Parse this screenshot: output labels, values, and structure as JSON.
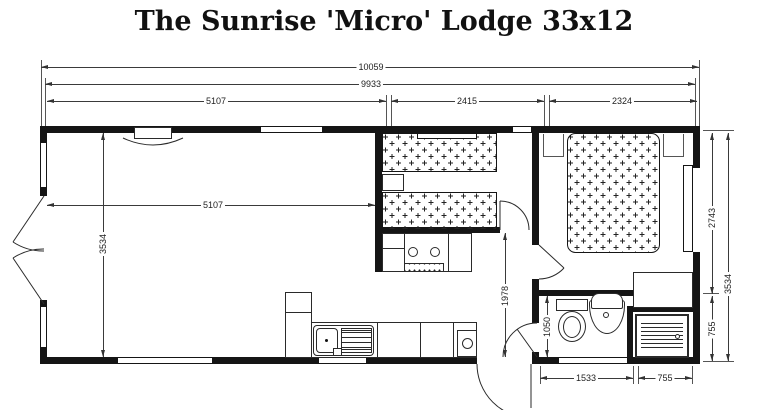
{
  "title": "The Sunrise 'Micro' Lodge 33x12",
  "dims": {
    "overall": "10059",
    "shell": "9933",
    "lounge_top": "5107",
    "twin_top": "2415",
    "master_top": "2324",
    "lounge_inner": "5107",
    "lounge_depth": "3534",
    "kitchen_depth": "1978",
    "wc_depth": "1050",
    "master_depth": "2743",
    "overall_depth": "3534",
    "shower_h": "755",
    "bath_len": "1533",
    "shower_w": "755"
  },
  "colors": {
    "wall": "#151515",
    "line": "#2a2a2a",
    "text": "#111111",
    "background": "#ffffff"
  }
}
